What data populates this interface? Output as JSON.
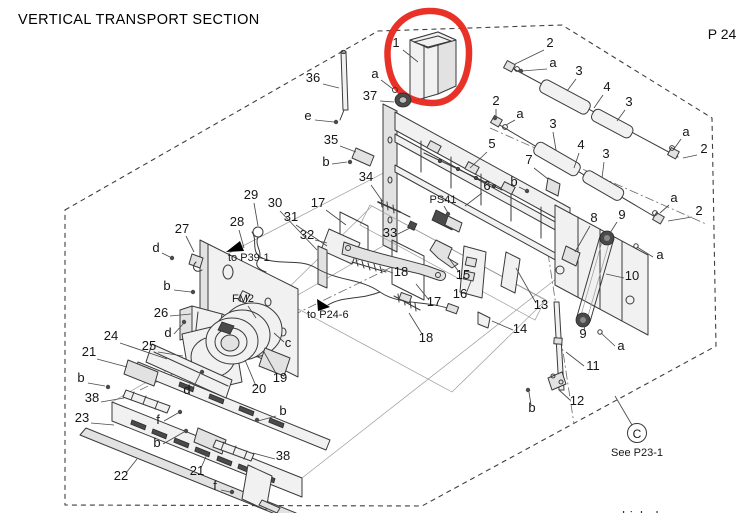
{
  "title": "VERTICAL TRANSPORT SECTION",
  "page_number": "P 24",
  "footer_partial": "bizhub",
  "highlight": {
    "shape": "freehand-circle",
    "color": "#e8271b",
    "around_part": "1"
  },
  "labels": {
    "sensor": "PS41",
    "fan": "FM2",
    "ref_p39": "to P39-1",
    "ref_p24": "to P24-6"
  },
  "reference_note": {
    "circle_letter": "C",
    "text": "See P23-1"
  },
  "diagram": {
    "callouts": [
      {
        "t": "1",
        "x": 396,
        "y": 47,
        "l": [
          403,
          50,
          418,
          62
        ]
      },
      {
        "t": "36",
        "x": 313,
        "y": 82,
        "l": [
          323,
          84,
          339,
          88
        ]
      },
      {
        "t": "a",
        "x": 375,
        "y": 78,
        "l": [
          381,
          80,
          393,
          89
        ]
      },
      {
        "t": "37",
        "x": 370,
        "y": 100,
        "l": [
          380,
          101,
          394,
          102
        ]
      },
      {
        "t": "e",
        "x": 308,
        "y": 120,
        "l": [
          315,
          120,
          334,
          122
        ]
      },
      {
        "t": "35",
        "x": 331,
        "y": 144,
        "l": [
          340,
          146,
          356,
          152
        ]
      },
      {
        "t": "b",
        "x": 326,
        "y": 166,
        "l": [
          332,
          164,
          347,
          162
        ]
      },
      {
        "t": "34",
        "x": 366,
        "y": 181,
        "l": [
          371,
          185,
          383,
          202
        ]
      },
      {
        "t": "17",
        "x": 318,
        "y": 207,
        "l": [
          326,
          210,
          346,
          225
        ]
      },
      {
        "t": "2",
        "x": 550,
        "y": 47,
        "l": [
          544,
          50,
          515,
          64
        ]
      },
      {
        "t": "a",
        "x": 553,
        "y": 67,
        "l": [
          547,
          69,
          522,
          71
        ]
      },
      {
        "t": "3",
        "x": 579,
        "y": 75,
        "l": [
          576,
          79,
          567,
          91
        ]
      },
      {
        "t": "4",
        "x": 607,
        "y": 91,
        "l": [
          603,
          95,
          594,
          108
        ]
      },
      {
        "t": "3",
        "x": 629,
        "y": 106,
        "l": [
          625,
          110,
          617,
          121
        ]
      },
      {
        "t": "a",
        "x": 686,
        "y": 136,
        "l": [
          681,
          139,
          674,
          149
        ]
      },
      {
        "t": "2",
        "x": 704,
        "y": 153,
        "l": [
          697,
          155,
          683,
          158
        ]
      },
      {
        "t": "2",
        "x": 496,
        "y": 105,
        "l": [
          496,
          109,
          496,
          118
        ]
      },
      {
        "t": "a",
        "x": 520,
        "y": 118,
        "l": [
          515,
          120,
          506,
          125
        ]
      },
      {
        "t": "3",
        "x": 553,
        "y": 128,
        "l": [
          553,
          132,
          556,
          150
        ]
      },
      {
        "t": "4",
        "x": 581,
        "y": 149,
        "l": [
          579,
          153,
          574,
          168
        ]
      },
      {
        "t": "3",
        "x": 606,
        "y": 158,
        "l": [
          604,
          162,
          602,
          178
        ]
      },
      {
        "t": "5",
        "x": 492,
        "y": 148,
        "l": [
          487,
          152,
          470,
          168
        ]
      },
      {
        "t": "7",
        "x": 529,
        "y": 164,
        "l": [
          534,
          168,
          548,
          179
        ]
      },
      {
        "t": "b",
        "x": 514,
        "y": 186,
        "l": [
          519,
          187,
          525,
          190
        ]
      },
      {
        "t": "6",
        "x": 487,
        "y": 190,
        "l": [
          482,
          193,
          465,
          206
        ]
      },
      {
        "t": "a",
        "x": 674,
        "y": 202,
        "l": [
          669,
          205,
          660,
          213
        ]
      },
      {
        "t": "2",
        "x": 699,
        "y": 215,
        "l": [
          692,
          217,
          668,
          221
        ]
      },
      {
        "t": "8",
        "x": 594,
        "y": 222,
        "l": [
          590,
          226,
          575,
          252
        ]
      },
      {
        "t": "9",
        "x": 622,
        "y": 219,
        "l": [
          617,
          222,
          610,
          233
        ]
      },
      {
        "t": "a",
        "x": 660,
        "y": 259,
        "l": [
          653,
          257,
          637,
          247
        ]
      },
      {
        "t": "10",
        "x": 632,
        "y": 280,
        "l": [
          624,
          278,
          606,
          274
        ]
      },
      {
        "t": "9",
        "x": 583,
        "y": 338,
        "l": [
          584,
          331,
          585,
          325
        ]
      },
      {
        "t": "a",
        "x": 621,
        "y": 350,
        "l": [
          615,
          346,
          601,
          333
        ]
      },
      {
        "t": "11",
        "x": 593,
        "y": 370,
        "l": [
          584,
          366,
          566,
          352
        ]
      },
      {
        "t": "12",
        "x": 577,
        "y": 405,
        "l": [
          570,
          400,
          559,
          390
        ]
      },
      {
        "t": "b",
        "x": 532,
        "y": 412,
        "l": [
          531,
          405,
          529,
          392
        ]
      },
      {
        "t": "13",
        "x": 541,
        "y": 309,
        "l": [
          536,
          303,
          516,
          268
        ]
      },
      {
        "t": "14",
        "x": 520,
        "y": 333,
        "l": [
          513,
          330,
          492,
          321
        ]
      },
      {
        "t": "16",
        "x": 460,
        "y": 298,
        "l": [
          466,
          294,
          471,
          281
        ]
      },
      {
        "t": "15",
        "x": 463,
        "y": 279,
        "l": [
          459,
          272,
          448,
          257
        ]
      },
      {
        "t": "17",
        "x": 434,
        "y": 306,
        "l": [
          429,
          300,
          416,
          284
        ]
      },
      {
        "t": "18",
        "x": 426,
        "y": 342,
        "l": [
          422,
          334,
          409,
          313
        ]
      },
      {
        "t": "18",
        "x": 401,
        "y": 276,
        "l": [
          393,
          273,
          382,
          269
        ]
      },
      {
        "t": "33",
        "x": 390,
        "y": 237,
        "l": [
          398,
          234,
          410,
          228
        ]
      },
      {
        "t": "32",
        "x": 307,
        "y": 239,
        "l": [
          315,
          240,
          327,
          243
        ]
      },
      {
        "t": "31",
        "x": 291,
        "y": 221,
        "l": [
          296,
          225,
          327,
          246
        ]
      },
      {
        "t": "30",
        "x": 275,
        "y": 207,
        "l": [
          280,
          211,
          317,
          250
        ]
      },
      {
        "t": "29",
        "x": 251,
        "y": 199,
        "l": [
          254,
          203,
          258,
          226
        ]
      },
      {
        "t": "28",
        "x": 237,
        "y": 226,
        "l": [
          239,
          230,
          244,
          248
        ]
      },
      {
        "t": "27",
        "x": 182,
        "y": 233,
        "l": [
          186,
          236,
          194,
          252
        ]
      },
      {
        "t": "d",
        "x": 156,
        "y": 252,
        "l": [
          162,
          253,
          170,
          257
        ]
      },
      {
        "t": "b",
        "x": 167,
        "y": 290,
        "l": [
          174,
          290,
          191,
          292
        ]
      },
      {
        "t": "26",
        "x": 161,
        "y": 317,
        "l": [
          170,
          316,
          191,
          314
        ]
      },
      {
        "t": "d",
        "x": 168,
        "y": 337,
        "l": [
          174,
          334,
          183,
          324
        ]
      },
      {
        "t": "24",
        "x": 111,
        "y": 340,
        "l": [
          120,
          343,
          167,
          359
        ]
      },
      {
        "t": "25",
        "x": 149,
        "y": 350,
        "l": [
          158,
          352,
          183,
          356
        ]
      },
      {
        "t": "21",
        "x": 89,
        "y": 356,
        "l": [
          97,
          359,
          127,
          367
        ]
      },
      {
        "t": "b",
        "x": 81,
        "y": 382,
        "l": [
          88,
          383,
          105,
          386
        ]
      },
      {
        "t": "38",
        "x": 92,
        "y": 402,
        "l": [
          101,
          402,
          124,
          398
        ]
      },
      {
        "t": "23",
        "x": 82,
        "y": 422,
        "l": [
          91,
          423,
          114,
          425
        ]
      },
      {
        "t": "22",
        "x": 121,
        "y": 480,
        "l": [
          126,
          473,
          137,
          459
        ]
      },
      {
        "t": "19",
        "x": 280,
        "y": 382,
        "l": [
          277,
          375,
          264,
          352
        ]
      },
      {
        "t": "20",
        "x": 259,
        "y": 393,
        "l": [
          256,
          386,
          245,
          360
        ]
      },
      {
        "t": "c",
        "x": 288,
        "y": 347,
        "l": [
          284,
          342,
          274,
          333
        ]
      },
      {
        "t": "d",
        "x": 187,
        "y": 394,
        "l": [
          192,
          390,
          200,
          374
        ]
      },
      {
        "t": "b",
        "x": 283,
        "y": 415,
        "l": [
          276,
          416,
          258,
          421
        ]
      },
      {
        "t": "21",
        "x": 197,
        "y": 475,
        "l": [
          201,
          468,
          208,
          452
        ]
      },
      {
        "t": "38",
        "x": 283,
        "y": 460,
        "l": [
          275,
          459,
          253,
          453
        ]
      },
      {
        "t": "f",
        "x": 158,
        "y": 424,
        "l": [
          164,
          421,
          178,
          413
        ]
      },
      {
        "t": "f",
        "x": 215,
        "y": 490,
        "l": [
          221,
          490,
          230,
          492
        ]
      },
      {
        "t": "b",
        "x": 157,
        "y": 447,
        "l": [
          163,
          444,
          184,
          432
        ]
      }
    ]
  }
}
